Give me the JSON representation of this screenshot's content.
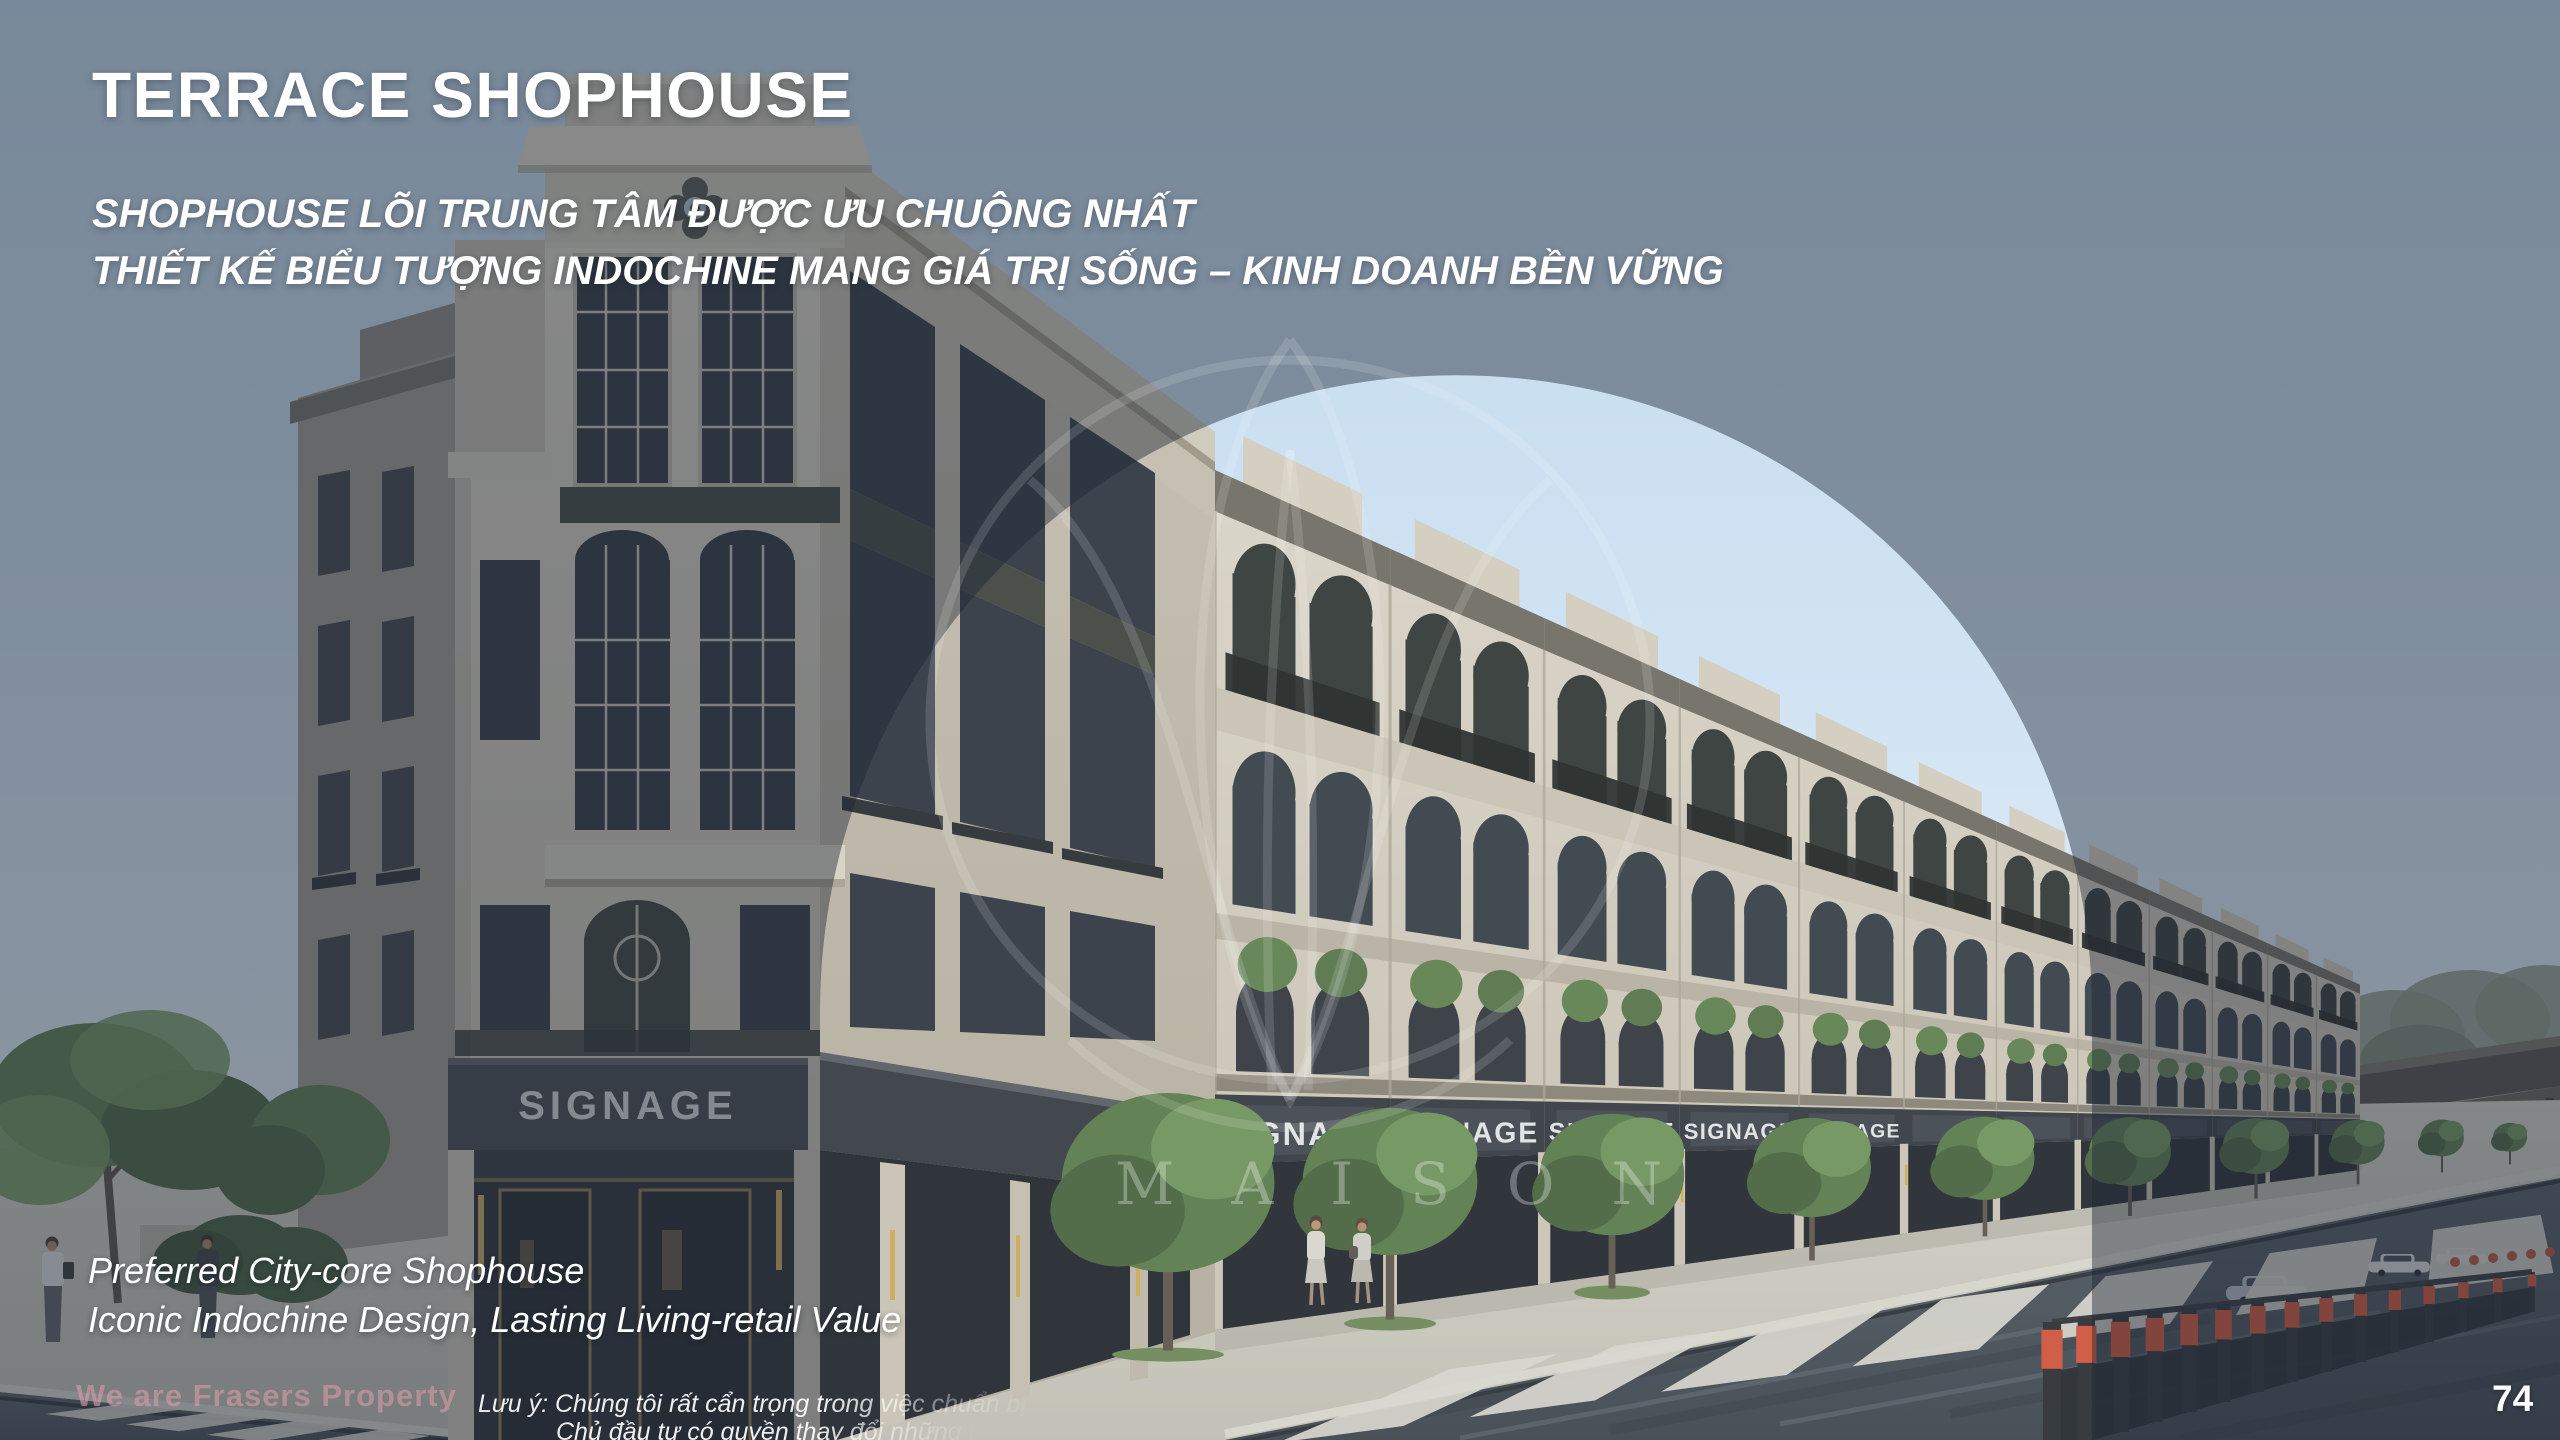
{
  "slide": {
    "title": "TERRACE SHOPHOUSE",
    "subtitle_lines": [
      "SHOPHOUSE LÕI TRUNG TÂM ĐƯỢC ƯU CHUỘNG NHẤT",
      "THIẾT KẾ BIỂU TƯỢNG INDOCHINE MANG GIÁ TRỊ SỐNG – KINH DOANH BỀN VỮNG"
    ],
    "tagline_lines": [
      "Preferred City-core Shophouse",
      "Iconic Indochine Design, Lasting Living-retail Value"
    ],
    "page_number": "74"
  },
  "footer": {
    "disclaimer_line1": "Lưu ý: Chúng tôi rất cẩn trọng trong việc chuẩn bị tài l",
    "disclaimer_line2": "Chủ đầu tư có quyền thay đổi những thô"
  },
  "watermarks": {
    "brand_text": "We are Frasers Property",
    "logo_text": "MAISON"
  },
  "scene": {
    "signage_label": "SIGNAGE",
    "colors": {
      "sky_dim": "#76808d",
      "sky_bright": "#cfe4f5",
      "facade_cream": "#d6cfc0",
      "storefront_dark": "#2f3237",
      "accent_red": "#cc4a30",
      "foliage_green": "#5d7d49",
      "road_gray": "#41474f",
      "gold_accent": "#d2a74f",
      "watermark_pink": "#d69da5"
    }
  }
}
